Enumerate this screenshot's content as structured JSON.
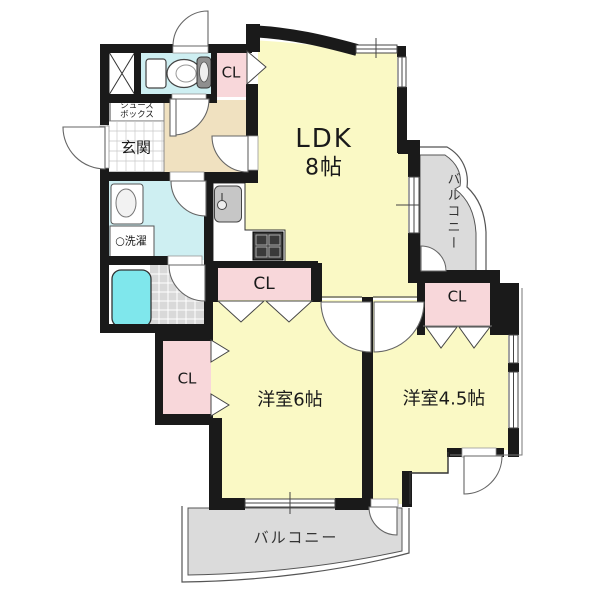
{
  "rooms": {
    "ldk": {
      "label": "LDK",
      "size": "8帖"
    },
    "room6": {
      "label": "洋室6帖"
    },
    "room45": {
      "label": "洋室4.5帖"
    },
    "entrance": {
      "label": "玄関"
    },
    "shoe_box": {
      "line1": "シューズ",
      "line2": "ボックス"
    },
    "laundry": {
      "label": "○洗濯"
    },
    "balcony_side": {
      "label": "バルコニー"
    },
    "balcony_bottom": {
      "label": "バルコニー"
    },
    "closet_hall": {
      "label": "CL"
    },
    "closet_ldk": {
      "label": "CL"
    },
    "closet_room6": {
      "label": "CL"
    },
    "closet_room45": {
      "label": "CL"
    }
  },
  "colors": {
    "wall": "#1a1a1a",
    "room_yellow": "#FAF9C5",
    "closet_pink": "#F8D7DA",
    "wet_area_cyan": "#CEEFF2",
    "bathtub_cyan": "#7FE7EC",
    "hallway_beige": "#F0E1C0",
    "balcony_gray": "#DBDBDB",
    "bath_tile_gray": "#D9D9D9"
  }
}
